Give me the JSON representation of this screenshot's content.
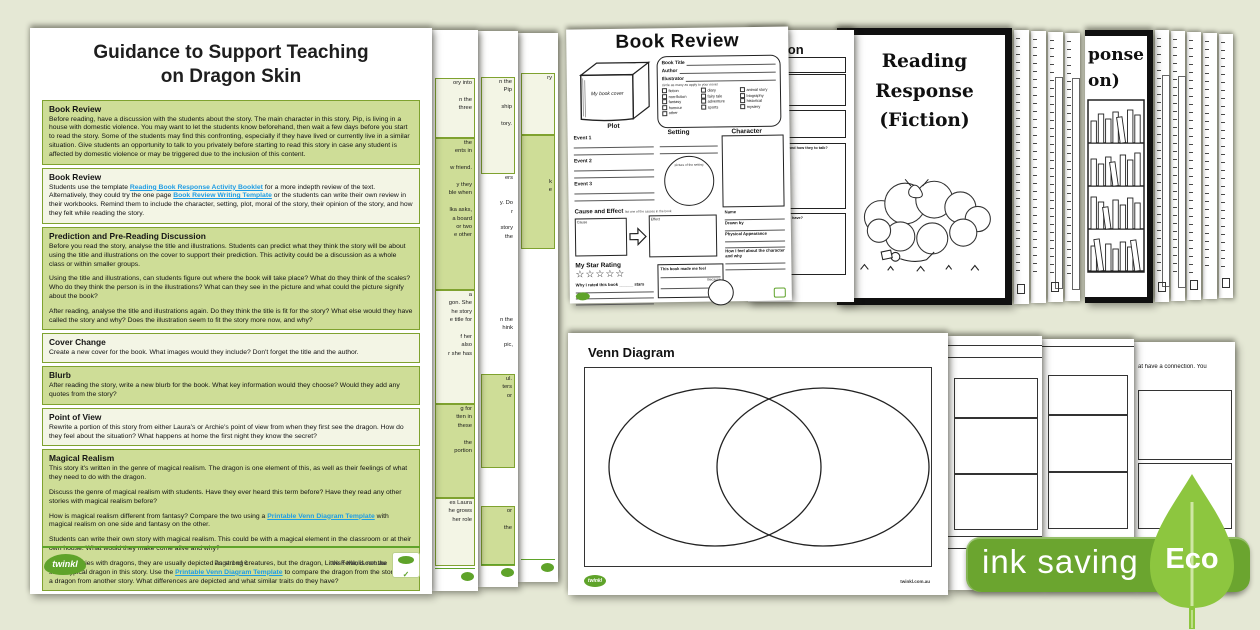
{
  "background": "#e5e8d5",
  "colors": {
    "section_green": "#cedd97",
    "section_light": "#f3f5e5",
    "section_border": "#7fa22f",
    "link_blue": "#1e9ce4",
    "twinkl_green": "#5fa32a",
    "badge_green": "#6ba52f",
    "leaf_green": "#8dc63f"
  },
  "icons": {
    "check": "✓",
    "star": "☆"
  },
  "guidance_page": {
    "title_line1": "Guidance to Support Teaching",
    "title_line2": "on Dragon Skin",
    "sections": [
      {
        "heading": "Book Review",
        "tone": "green",
        "paragraphs": [
          [
            {
              "t": "Before reading, have a discussion with the students about the story. The main character in this story, Pip, is living in a house with domestic violence. You may want to let the students know beforehand, then wait a few days before you start to read the story. Some of the students may find this confronting, especially if they have lived or currently live in a similar situation. Give students an opportunity to talk to you privately before starting to read this story in case any student is affected by domestic violence or may be triggered due to the inclusion of this content."
            }
          ]
        ]
      },
      {
        "heading": "Book Review",
        "tone": "light",
        "paragraphs": [
          [
            {
              "t": "Students use the template "
            },
            {
              "t": "Reading Book Response Activity Booklet",
              "link": true
            },
            {
              "t": " for a more indepth review of the text. Alternatively, they could try the one page "
            },
            {
              "t": "Book Review Writing Template",
              "link": true
            },
            {
              "t": " or the students can write their own review in their workbooks. Remind them to include the character, setting, plot, moral of the story, their opinion of the story, and how they felt while reading the story."
            }
          ]
        ]
      },
      {
        "heading": "Prediction and Pre-Reading Discussion",
        "tone": "green",
        "paragraphs": [
          [
            {
              "t": "Before you read the story, analyse the title and illustrations. Students can predict what they think the story will be about using the title and illustrations on the cover to support their prediction. This activity could be a discussion as a whole class or within smaller groups."
            }
          ],
          [
            {
              "t": "Using the title and illustrations, can students figure out where the book will take place? What do they think of the scales? Who do they think the person is in the illustrations? What can they see in the picture and what could the picture signify about the book?"
            }
          ],
          [
            {
              "t": "After reading, analyse the title and illustrations again. Do they think the title is fit for the story? What else would they have called the story and why? Does the illustration seem to fit the story more now, and why?"
            }
          ]
        ]
      },
      {
        "heading": "Cover Change",
        "tone": "light",
        "paragraphs": [
          [
            {
              "t": "Create a new cover for the book. What images would they include? Don't forget the title and the author."
            }
          ]
        ]
      },
      {
        "heading": "Blurb",
        "tone": "green",
        "paragraphs": [
          [
            {
              "t": "After reading the story, write a new blurb for the book. What key information would they choose? Would they add any quotes from the story?"
            }
          ]
        ]
      },
      {
        "heading": "Point of View",
        "tone": "light",
        "paragraphs": [
          [
            {
              "t": "Rewrite a portion of this story from either Laura's or Archie's point of view from when they first see the dragon. How do they feel about the situation? What happens at home the first night they know the secret?"
            }
          ]
        ]
      },
      {
        "heading": "Magical Realism",
        "tone": "green",
        "paragraphs": [
          [
            {
              "t": "This story it's written in the genre of magical realism. The dragon is one element of this, as well as their feelings of what they need to do with the dragon."
            }
          ],
          [
            {
              "t": "Discuss the genre of magical realism with students. Have they ever heard this term before? Have they read any other stories with magical realism before?"
            }
          ],
          [
            {
              "t": "How is magical realism different from fantasy? Compare the two using a "
            },
            {
              "t": "Printable Venn Diagram Template",
              "link": true
            },
            {
              "t": " with magical realism on one side and fantasy on the other."
            }
          ],
          [
            {
              "t": "Students can write their own story with magical realism. This could be with a magical element in the classroom or at their own house. What would they make come alive and why?"
            }
          ],
          [
            {
              "t": "In other stories with dragons, they are usually depicted as strong creatures, but the dragon, Little Fella, is not the stereotypical dragon in this story. Use the "
            },
            {
              "t": "Printable Venn Diagram Template",
              "link": true
            },
            {
              "t": " to compare the dragon from the story and a dragon from another story. What differences are depicted and what similar traits do they have?"
            }
          ]
        ]
      }
    ],
    "footer": {
      "page_label": "Page 1 of 6",
      "site_label": "visit twinkl.com.au",
      "logo_text": "twinkl"
    }
  },
  "left_page_edges": [
    {
      "blocks": [
        {
          "tone": "plain",
          "h": 48,
          "lines": []
        },
        {
          "tone": "light",
          "h": 58,
          "lines": [
            "ory into",
            "",
            "n the",
            "three"
          ]
        },
        {
          "tone": "green",
          "h": 150,
          "lines": [
            "the",
            "ents in",
            "",
            "w friend.",
            "",
            "y they",
            "ble when",
            "",
            "lka asks,",
            "a board",
            "or two",
            "e other"
          ]
        },
        {
          "tone": "light",
          "h": 112,
          "lines": [
            "a",
            "gon. She",
            "he story",
            "e title for",
            "",
            "f her",
            "also",
            "r she has"
          ]
        },
        {
          "tone": "green",
          "h": 92,
          "lines": [
            "g for",
            "tten in",
            "these",
            "",
            "the",
            "portion"
          ]
        },
        {
          "tone": "light",
          "h": 66,
          "lines": [
            "es Laura",
            "he grows",
            "her role"
          ]
        }
      ]
    },
    {
      "blocks": [
        {
          "tone": "plain",
          "h": 46,
          "lines": []
        },
        {
          "tone": "light",
          "h": 95,
          "lines": [
            "n the",
            "Pip",
            "",
            "ship",
            "",
            "tory."
          ]
        },
        {
          "tone": "plain",
          "h": 142,
          "lines": [
            "ers",
            "",
            "",
            "y. Do",
            "r",
            "",
            "story",
            "the"
          ]
        },
        {
          "tone": "plain",
          "h": 58,
          "lines": [
            "n the",
            "hink",
            "",
            "pic,"
          ]
        },
        {
          "tone": "green",
          "h": 92,
          "lines": [
            "ul.",
            "ters",
            "or"
          ]
        },
        {
          "tone": "plain",
          "h": 38,
          "lines": []
        },
        {
          "tone": "green",
          "h": 58,
          "lines": [
            "or",
            "",
            "the"
          ]
        }
      ]
    },
    {
      "blocks": [
        {
          "tone": "plain",
          "h": 40,
          "lines": []
        },
        {
          "tone": "light",
          "h": 60,
          "lines": [
            "ry"
          ]
        },
        {
          "tone": "green",
          "h": 112,
          "lines": [
            "",
            "",
            "",
            "",
            "",
            "k",
            "e"
          ]
        },
        {
          "tone": "plain",
          "h": 250,
          "lines": []
        }
      ]
    }
  ],
  "book_review_sheet": {
    "title": "Book Review",
    "book_cover_label": "My book cover",
    "fields": [
      "Book Title",
      "Author",
      "Illustrator"
    ],
    "genre_caption": "circle as many as apply to your novel",
    "genre_columns": [
      [
        "fiction",
        "non-fiction",
        "fantasy",
        "humour",
        "other"
      ],
      [
        "diary",
        "fairy tale",
        "adventure",
        "sports"
      ],
      [
        "animal story",
        "biography",
        "historical",
        "mystery"
      ]
    ],
    "plot_label": "Plot",
    "plot_events": [
      "Event 1",
      "Event 2",
      "Event 3"
    ],
    "setting_label": "Setting",
    "setting_caption": "picture of the setting",
    "character_label": "Character",
    "cause_effect_label": "Cause and Effect",
    "cause_effect_note": "list one of the causes in the book",
    "cause_label": "Cause",
    "effect_label": "Effect",
    "star_rating_label": "My Star Rating",
    "star_count": 5,
    "rating_caption": "Why I rated this book ______ stars",
    "feel_label": "This book made me feel",
    "because_label": "Because",
    "name_label": "Name",
    "drawn_by_label": "Drawn by",
    "appearance_label": "Physical Appearance",
    "feeling_label": "How I feel about the character and why"
  },
  "character_description_sheet": {
    "title_fragment": "cription",
    "box_labels": [
      "How they to walk and how they to talk?",
      "What home they to have?"
    ]
  },
  "reading_response_cover": {
    "title_line1": "Reading Response",
    "title_line2": "(Fiction)"
  },
  "reading_response_cover_back": {
    "title_fragments": [
      "ponse",
      "on)"
    ]
  },
  "stack_counts": {
    "between_covers": 4,
    "right_of_covers": 5
  },
  "venn_sheet": {
    "title": "Venn Diagram",
    "logo_text": "twinkl",
    "site_label": "twinkl.com.au"
  },
  "box_pages": [
    {
      "boxes": 3
    },
    {
      "boxes": 3
    },
    {
      "text_fragment": "at have a connection. You",
      "boxes": 2
    }
  ],
  "eco_badge": {
    "label": "ink saving",
    "eco_label": "Eco"
  }
}
